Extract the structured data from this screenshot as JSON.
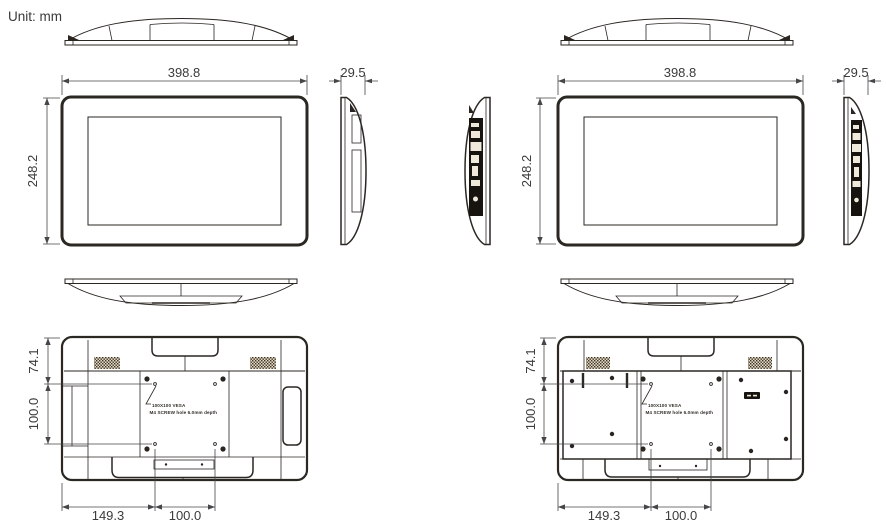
{
  "unit_label": "Unit: mm",
  "colors": {
    "background": "#ffffff",
    "body_fill": "#ebe0c9",
    "outline": "#2b2722",
    "dimension_text": "#3b3b3d",
    "io_panel": "#17130e"
  },
  "variant_a": {
    "width": "398.8",
    "depth": "29.5",
    "height": "248.2",
    "vesa_top_offset": "74.1",
    "vesa_vertical_spacing": "100.0",
    "vesa_left_offset": "149.3",
    "vesa_horizontal_spacing": "100.0",
    "vesa_note_line1": "100X100 VESA",
    "vesa_note_line2": "M4 SCREW hole 6.0mm depth"
  },
  "variant_b": {
    "width": "398.8",
    "depth": "29.5",
    "height": "248.2",
    "vesa_top_offset": "74.1",
    "vesa_vertical_spacing": "100.0",
    "vesa_left_offset": "149.3",
    "vesa_horizontal_spacing": "100.0",
    "vesa_note_line1": "100X100 VESA",
    "vesa_note_line2": "M4 SCREW hole 6.0mm depth"
  }
}
